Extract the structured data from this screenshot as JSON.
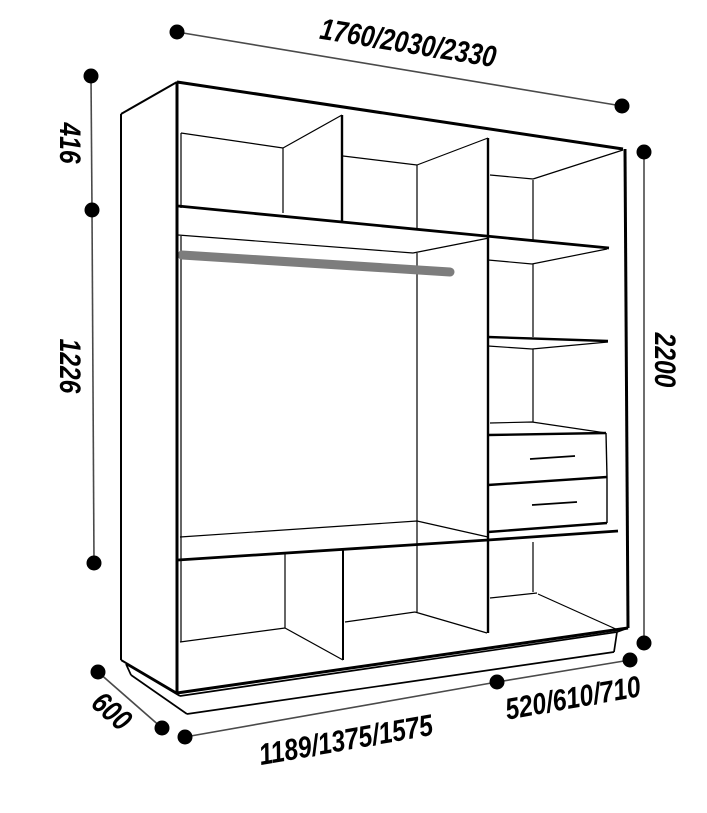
{
  "diagram": {
    "title": "wardrobe-interior-dimension-drawing",
    "dimensions": {
      "width_options": "1760/2030/2330",
      "top_section_height": "416",
      "hanging_section_height": "1226",
      "total_height": "2200",
      "depth": "600",
      "hanging_width_options": "1189/1375/1575",
      "side_column_width_options": "520/610/710"
    },
    "colors": {
      "line": "#000000",
      "dimension_line": "#4a4a4a",
      "dot": "#000000",
      "hanging_rod": "#7d7d7d",
      "background": "#ffffff"
    }
  }
}
